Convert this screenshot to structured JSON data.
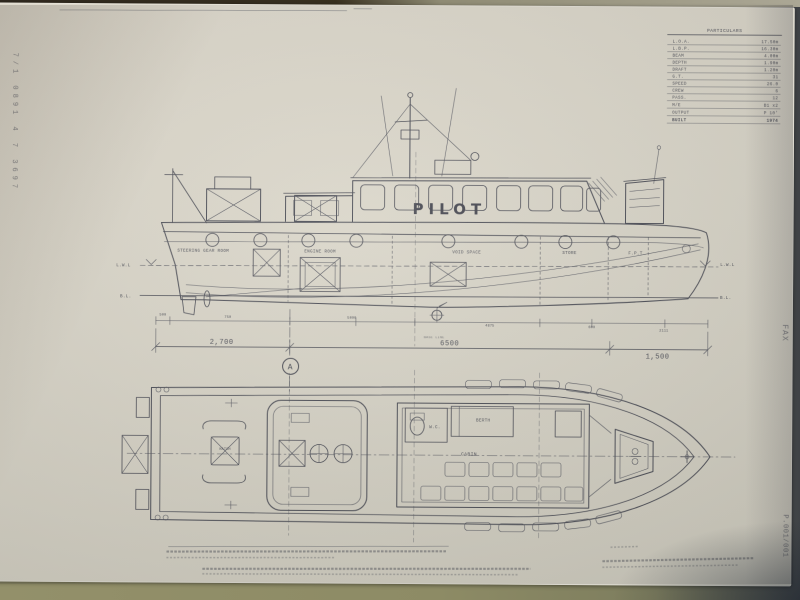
{
  "margins": {
    "left_vertical": "7/1 0891 4 7 3697",
    "right_fax": "FAX",
    "right_page": "P.001/001"
  },
  "spec_table": {
    "title": "PARTICULARS",
    "rows": [
      {
        "label": "L.O.A.",
        "value": "17.50m"
      },
      {
        "label": "L.B.P.",
        "value": "16.30m"
      },
      {
        "label": "BEAM",
        "value": "4.00m"
      },
      {
        "label": "DEPTH",
        "value": "1.90m"
      },
      {
        "label": "DRAFT",
        "value": "1.20m"
      },
      {
        "label": "G.T.",
        "value": "31"
      },
      {
        "label": "SPEED",
        "value": "26.0"
      },
      {
        "label": "CREW",
        "value": "6"
      },
      {
        "label": "PASS.",
        "value": "12"
      },
      {
        "label": "M/E",
        "value": "B1 x2"
      },
      {
        "label": "OUTPUT",
        "value": "P 10'"
      },
      {
        "label": "BUILT",
        "value": "1974"
      }
    ]
  },
  "profile": {
    "sign": "PILOT",
    "compartments": {
      "aft": "STEERING GEAR ROOM",
      "engine": "ENGINE ROOM",
      "mid": "VOID SPACE",
      "store": "STORE",
      "fore": "F.P.T"
    },
    "waterline": "L.W.L",
    "baseline_abbr": "B.L.",
    "baseline_label": "BASE LINE"
  },
  "dimensions": {
    "upper": [
      "500",
      "750",
      "5000",
      "4875",
      "600",
      "2111"
    ],
    "main": [
      "2,700",
      "6500",
      "1,500"
    ],
    "section_mark": "A"
  },
  "plan": {
    "wc": "W.C.",
    "berth": "BERTH",
    "cabin": "CABIN",
    "hatch": "HATCH"
  }
}
